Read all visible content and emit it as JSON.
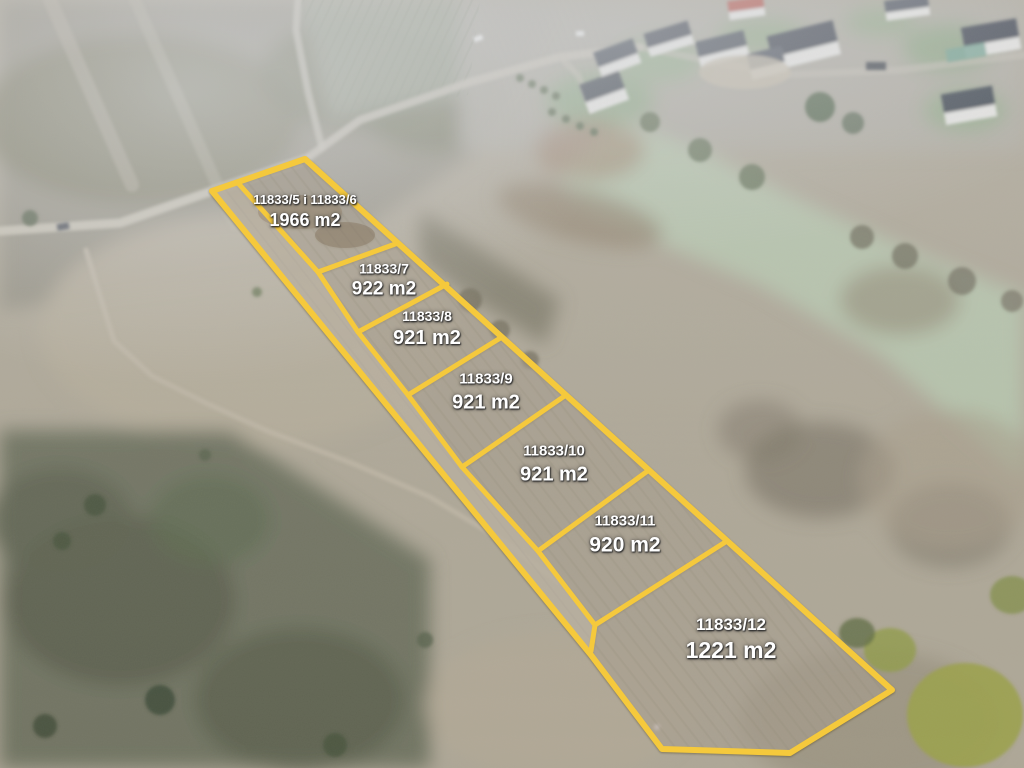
{
  "scene": {
    "type": "aerial-drone-photo",
    "subject": "building plots for sale marked with yellow boundaries on scrubland near a housing estate"
  },
  "colors": {
    "boundary_yellow": "#F5C93C",
    "label_text": "#FFFFFF",
    "label_shadow": "#2D2D2D",
    "terrain_base": "#ADA695",
    "meadow_green": "#B4C3AA",
    "woodland_dark": "#6A6E5C",
    "roof_dark": "#3D434C",
    "roof_red": "#B4544A",
    "house_wall": "#E9E8E4"
  },
  "parcels": [
    {
      "plot": "11833/5 i 11833/6",
      "area": "1966 m2",
      "x": 305,
      "y": 212,
      "num_size": 13,
      "area_size": 18
    },
    {
      "plot": "11833/7",
      "area": "922 m2",
      "x": 384,
      "y": 281,
      "num_size": 14,
      "area_size": 19
    },
    {
      "plot": "11833/8",
      "area": "921 m2",
      "x": 427,
      "y": 329,
      "num_size": 14,
      "area_size": 20
    },
    {
      "plot": "11833/9",
      "area": "921 m2",
      "x": 486,
      "y": 392,
      "num_size": 15,
      "area_size": 20
    },
    {
      "plot": "11833/10",
      "area": "921 m2",
      "x": 554,
      "y": 464,
      "num_size": 15,
      "area_size": 20
    },
    {
      "plot": "11833/11",
      "area": "920 m2",
      "x": 625,
      "y": 535,
      "num_size": 15,
      "area_size": 21
    },
    {
      "plot": "11833/12",
      "area": "1221 m2",
      "x": 731,
      "y": 640,
      "num_size": 17,
      "area_size": 23
    }
  ],
  "geometry": {
    "outer": [
      [
        212,
        191
      ],
      [
        305,
        159
      ],
      [
        892,
        690
      ],
      [
        790,
        753
      ],
      [
        662,
        749
      ],
      [
        591,
        655
      ]
    ],
    "inner_line": [
      [
        238,
        183
      ],
      [
        318,
        272
      ],
      [
        358,
        332
      ],
      [
        408,
        395
      ],
      [
        462,
        467
      ],
      [
        538,
        551
      ],
      [
        595,
        625
      ],
      [
        591,
        651
      ]
    ],
    "dividers": [
      [
        [
          318,
          272
        ],
        [
          398,
          243
        ]
      ],
      [
        [
          358,
          332
        ],
        [
          447,
          284
        ]
      ],
      [
        [
          408,
          395
        ],
        [
          502,
          337
        ]
      ],
      [
        [
          462,
          467
        ],
        [
          566,
          395
        ]
      ],
      [
        [
          538,
          551
        ],
        [
          649,
          470
        ]
      ],
      [
        [
          595,
          625
        ],
        [
          727,
          541
        ]
      ]
    ],
    "line_width_outer": 6,
    "line_width_inner": 5
  }
}
